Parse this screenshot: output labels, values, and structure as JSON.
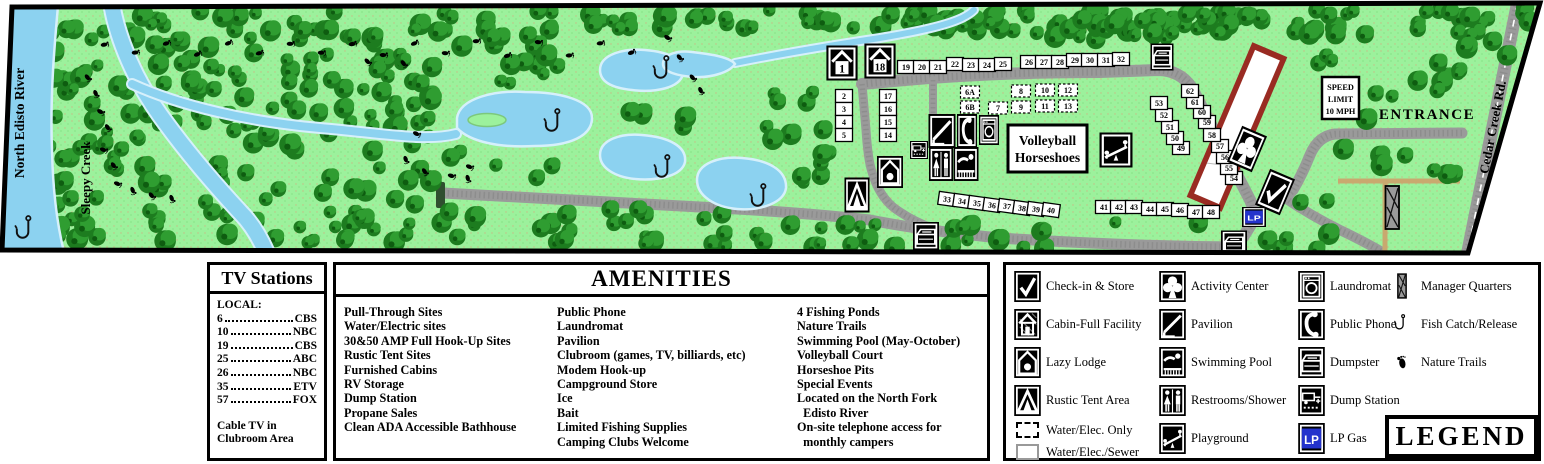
{
  "map": {
    "river_label": "North Edisto River",
    "creek_label": "Sleepy Creek",
    "entrance_label": "ENTRANCE",
    "road_label": "Cedar Creek Rd.",
    "speed_sign_lines": [
      "SPEED",
      "LIMIT",
      "10 MPH"
    ],
    "court_sign_lines": [
      "Volleyball",
      "Horseshoes"
    ],
    "lp_label": "LP",
    "colors": {
      "background_green": "#9CF19C",
      "tree_green": "#2F9D31",
      "water_blue": "#8CD2F0",
      "road_gray": "#9A9A9A",
      "dirt_tan": "#C9A96F",
      "building_red": "#992B22",
      "lp_blue": "#2433CC"
    },
    "cabins": [
      {
        "n": "1",
        "x": 842,
        "y": 63
      },
      {
        "n": "18",
        "x": 880,
        "y": 61
      }
    ],
    "sites_solid": [
      {
        "n": "19",
        "x": 906,
        "y": 67
      },
      {
        "n": "20",
        "x": 922,
        "y": 67
      },
      {
        "n": "21",
        "x": 938,
        "y": 67
      },
      {
        "n": "22",
        "x": 955,
        "y": 64
      },
      {
        "n": "23",
        "x": 971,
        "y": 65
      },
      {
        "n": "24",
        "x": 987,
        "y": 65
      },
      {
        "n": "25",
        "x": 1003,
        "y": 64
      },
      {
        "n": "26",
        "x": 1029,
        "y": 62
      },
      {
        "n": "27",
        "x": 1044,
        "y": 62
      },
      {
        "n": "28",
        "x": 1060,
        "y": 62
      },
      {
        "n": "29",
        "x": 1075,
        "y": 60
      },
      {
        "n": "30",
        "x": 1090,
        "y": 60
      },
      {
        "n": "31",
        "x": 1106,
        "y": 60
      },
      {
        "n": "32",
        "x": 1121,
        "y": 59
      },
      {
        "n": "2",
        "x": 844,
        "y": 96
      },
      {
        "n": "3",
        "x": 844,
        "y": 109
      },
      {
        "n": "4",
        "x": 844,
        "y": 122
      },
      {
        "n": "5",
        "x": 844,
        "y": 135
      },
      {
        "n": "17",
        "x": 888,
        "y": 96
      },
      {
        "n": "16",
        "x": 888,
        "y": 109
      },
      {
        "n": "15",
        "x": 888,
        "y": 122
      },
      {
        "n": "14",
        "x": 888,
        "y": 135
      },
      {
        "n": "33",
        "x": 947,
        "y": 199,
        "r": 8
      },
      {
        "n": "34",
        "x": 962,
        "y": 201,
        "r": 8
      },
      {
        "n": "35",
        "x": 977,
        "y": 203,
        "r": 8
      },
      {
        "n": "36",
        "x": 992,
        "y": 205,
        "r": 8
      },
      {
        "n": "37",
        "x": 1007,
        "y": 206,
        "r": 8
      },
      {
        "n": "38",
        "x": 1022,
        "y": 208,
        "r": 8
      },
      {
        "n": "39",
        "x": 1036,
        "y": 209,
        "r": 8
      },
      {
        "n": "40",
        "x": 1051,
        "y": 210,
        "r": 8
      },
      {
        "n": "41",
        "x": 1104,
        "y": 207
      },
      {
        "n": "42",
        "x": 1119,
        "y": 207
      },
      {
        "n": "43",
        "x": 1134,
        "y": 207
      },
      {
        "n": "44",
        "x": 1150,
        "y": 209
      },
      {
        "n": "45",
        "x": 1165,
        "y": 209
      },
      {
        "n": "46",
        "x": 1180,
        "y": 210
      },
      {
        "n": "47",
        "x": 1196,
        "y": 212
      },
      {
        "n": "48",
        "x": 1211,
        "y": 212
      },
      {
        "n": "49",
        "x": 1181,
        "y": 148
      },
      {
        "n": "50",
        "x": 1175,
        "y": 138
      },
      {
        "n": "51",
        "x": 1170,
        "y": 127
      },
      {
        "n": "52",
        "x": 1164,
        "y": 115
      },
      {
        "n": "53",
        "x": 1159,
        "y": 103
      },
      {
        "n": "54",
        "x": 1234,
        "y": 178
      },
      {
        "n": "55",
        "x": 1229,
        "y": 168
      },
      {
        "n": "56",
        "x": 1225,
        "y": 157
      },
      {
        "n": "57",
        "x": 1220,
        "y": 146
      },
      {
        "n": "58",
        "x": 1212,
        "y": 135
      },
      {
        "n": "59",
        "x": 1207,
        "y": 122
      },
      {
        "n": "60",
        "x": 1202,
        "y": 112
      },
      {
        "n": "61",
        "x": 1195,
        "y": 102
      },
      {
        "n": "62",
        "x": 1190,
        "y": 91
      }
    ],
    "sites_dashed": [
      {
        "n": "6A",
        "x": 970,
        "y": 92
      },
      {
        "n": "6B",
        "x": 970,
        "y": 107
      },
      {
        "n": "7",
        "x": 998,
        "y": 108
      },
      {
        "n": "8",
        "x": 1021,
        "y": 91
      },
      {
        "n": "9",
        "x": 1021,
        "y": 107
      },
      {
        "n": "10",
        "x": 1045,
        "y": 90
      },
      {
        "n": "11",
        "x": 1045,
        "y": 106
      },
      {
        "n": "12",
        "x": 1068,
        "y": 90
      },
      {
        "n": "13",
        "x": 1068,
        "y": 106
      }
    ],
    "icons": [
      {
        "t": "pavilion",
        "x": 942,
        "y": 131,
        "w": 27,
        "h": 34
      },
      {
        "t": "phone",
        "x": 967,
        "y": 131,
        "w": 20,
        "h": 34
      },
      {
        "t": "laundry",
        "x": 989,
        "y": 130,
        "w": 20,
        "h": 30
      },
      {
        "t": "restroom",
        "x": 941,
        "y": 164,
        "w": 24,
        "h": 34
      },
      {
        "t": "pool",
        "x": 966,
        "y": 164,
        "w": 25,
        "h": 34
      },
      {
        "t": "dumpstation",
        "x": 919,
        "y": 150,
        "w": 18,
        "h": 18
      },
      {
        "t": "lodge",
        "x": 890,
        "y": 172,
        "w": 26,
        "h": 32
      },
      {
        "t": "tent",
        "x": 857,
        "y": 195,
        "w": 25,
        "h": 35
      },
      {
        "t": "playground",
        "x": 1116,
        "y": 150,
        "w": 33,
        "h": 35
      },
      {
        "t": "activity",
        "x": 1247,
        "y": 149,
        "w": 27,
        "h": 39,
        "r": 23
      },
      {
        "t": "checkin",
        "x": 1275,
        "y": 192,
        "w": 27,
        "h": 39,
        "r": 23
      },
      {
        "t": "lp",
        "x": 1254,
        "y": 217,
        "w": 24,
        "h": 20
      },
      {
        "t": "dumpster",
        "x": 1162,
        "y": 57,
        "w": 23,
        "h": 27
      },
      {
        "t": "dumpster",
        "x": 926,
        "y": 236,
        "w": 26,
        "h": 28
      },
      {
        "t": "dumpster",
        "x": 1234,
        "y": 243,
        "w": 26,
        "h": 25
      }
    ],
    "fish_hooks": [
      {
        "x": 22,
        "y": 228
      },
      {
        "x": 551,
        "y": 121
      },
      {
        "x": 660,
        "y": 68
      },
      {
        "x": 661,
        "y": 167
      },
      {
        "x": 757,
        "y": 196
      }
    ]
  },
  "tv_panel": {
    "title": "TV Stations",
    "subtitle": "LOCAL:",
    "stations": [
      {
        "ch": "6",
        "net": "CBS"
      },
      {
        "ch": "10",
        "net": "NBC"
      },
      {
        "ch": "19",
        "net": "CBS"
      },
      {
        "ch": "25",
        "net": "ABC"
      },
      {
        "ch": "26",
        "net": "NBC"
      },
      {
        "ch": "35",
        "net": "ETV"
      },
      {
        "ch": "57",
        "net": "FOX"
      }
    ],
    "footer_line1": "Cable TV  in",
    "footer_line2": "Clubroom Area"
  },
  "amenities_panel": {
    "title": "AMENITIES",
    "columns": [
      [
        "Pull-Through Sites",
        "Water/Electric sites",
        "30&50 AMP Full Hook-Up Sites",
        "Rustic Tent Sites",
        "Furnished Cabins",
        "RV Storage",
        "Dump Station",
        "Propane Sales",
        "Clean ADA Accessible Bathhouse"
      ],
      [
        "Public Phone",
        "Laundromat",
        "Pavilion",
        "Clubroom (games, TV, billiards, etc)",
        "Modem Hook-up",
        "Campground Store",
        "Ice",
        "Bait",
        "Limited Fishing Supplies",
        "Camping Clubs Welcome"
      ],
      [
        "4 Fishing Ponds",
        "Nature Trails",
        "Swimming Pool (May-October)",
        "Volleyball Court",
        "Horseshoe Pits",
        "Special Events",
        "Located on the North Fork",
        "  Edisto River",
        "On-site telephone access for",
        "  monthly campers"
      ]
    ]
  },
  "legend_panel": {
    "title": "LEGEND",
    "columns": [
      [
        {
          "icon": "checkin",
          "label": "Check-in & Store"
        },
        {
          "icon": "cabin",
          "label": "Cabin-Full Facility"
        },
        {
          "icon": "lodge",
          "label": "Lazy Lodge"
        },
        {
          "icon": "tent",
          "label": "Rustic Tent Area"
        },
        {
          "icon": "dashedbox",
          "label": "Water/Elec. Only"
        },
        {
          "icon": "solidbox",
          "label": "Water/Elec./Sewer"
        }
      ],
      [
        {
          "icon": "activity",
          "label": "Activity Center"
        },
        {
          "icon": "pavilion",
          "label": "Pavilion"
        },
        {
          "icon": "pool",
          "label": "Swimming Pool"
        },
        {
          "icon": "restroom",
          "label": "Restrooms/Shower"
        },
        {
          "icon": "playground",
          "label": "Playground"
        }
      ],
      [
        {
          "icon": "laundry",
          "label": "Laundromat"
        },
        {
          "icon": "phone",
          "label": "Public Phone"
        },
        {
          "icon": "dumpster",
          "label": "Dumpster"
        },
        {
          "icon": "dumpstation",
          "label": "Dump Station"
        },
        {
          "icon": "lp",
          "label": "LP Gas"
        }
      ],
      [
        {
          "icon": "manager",
          "label": "Manager Quarters"
        },
        {
          "icon": "hook",
          "label": "Fish Catch/Release"
        },
        {
          "icon": "foot",
          "label": "Nature Trails"
        }
      ]
    ]
  }
}
